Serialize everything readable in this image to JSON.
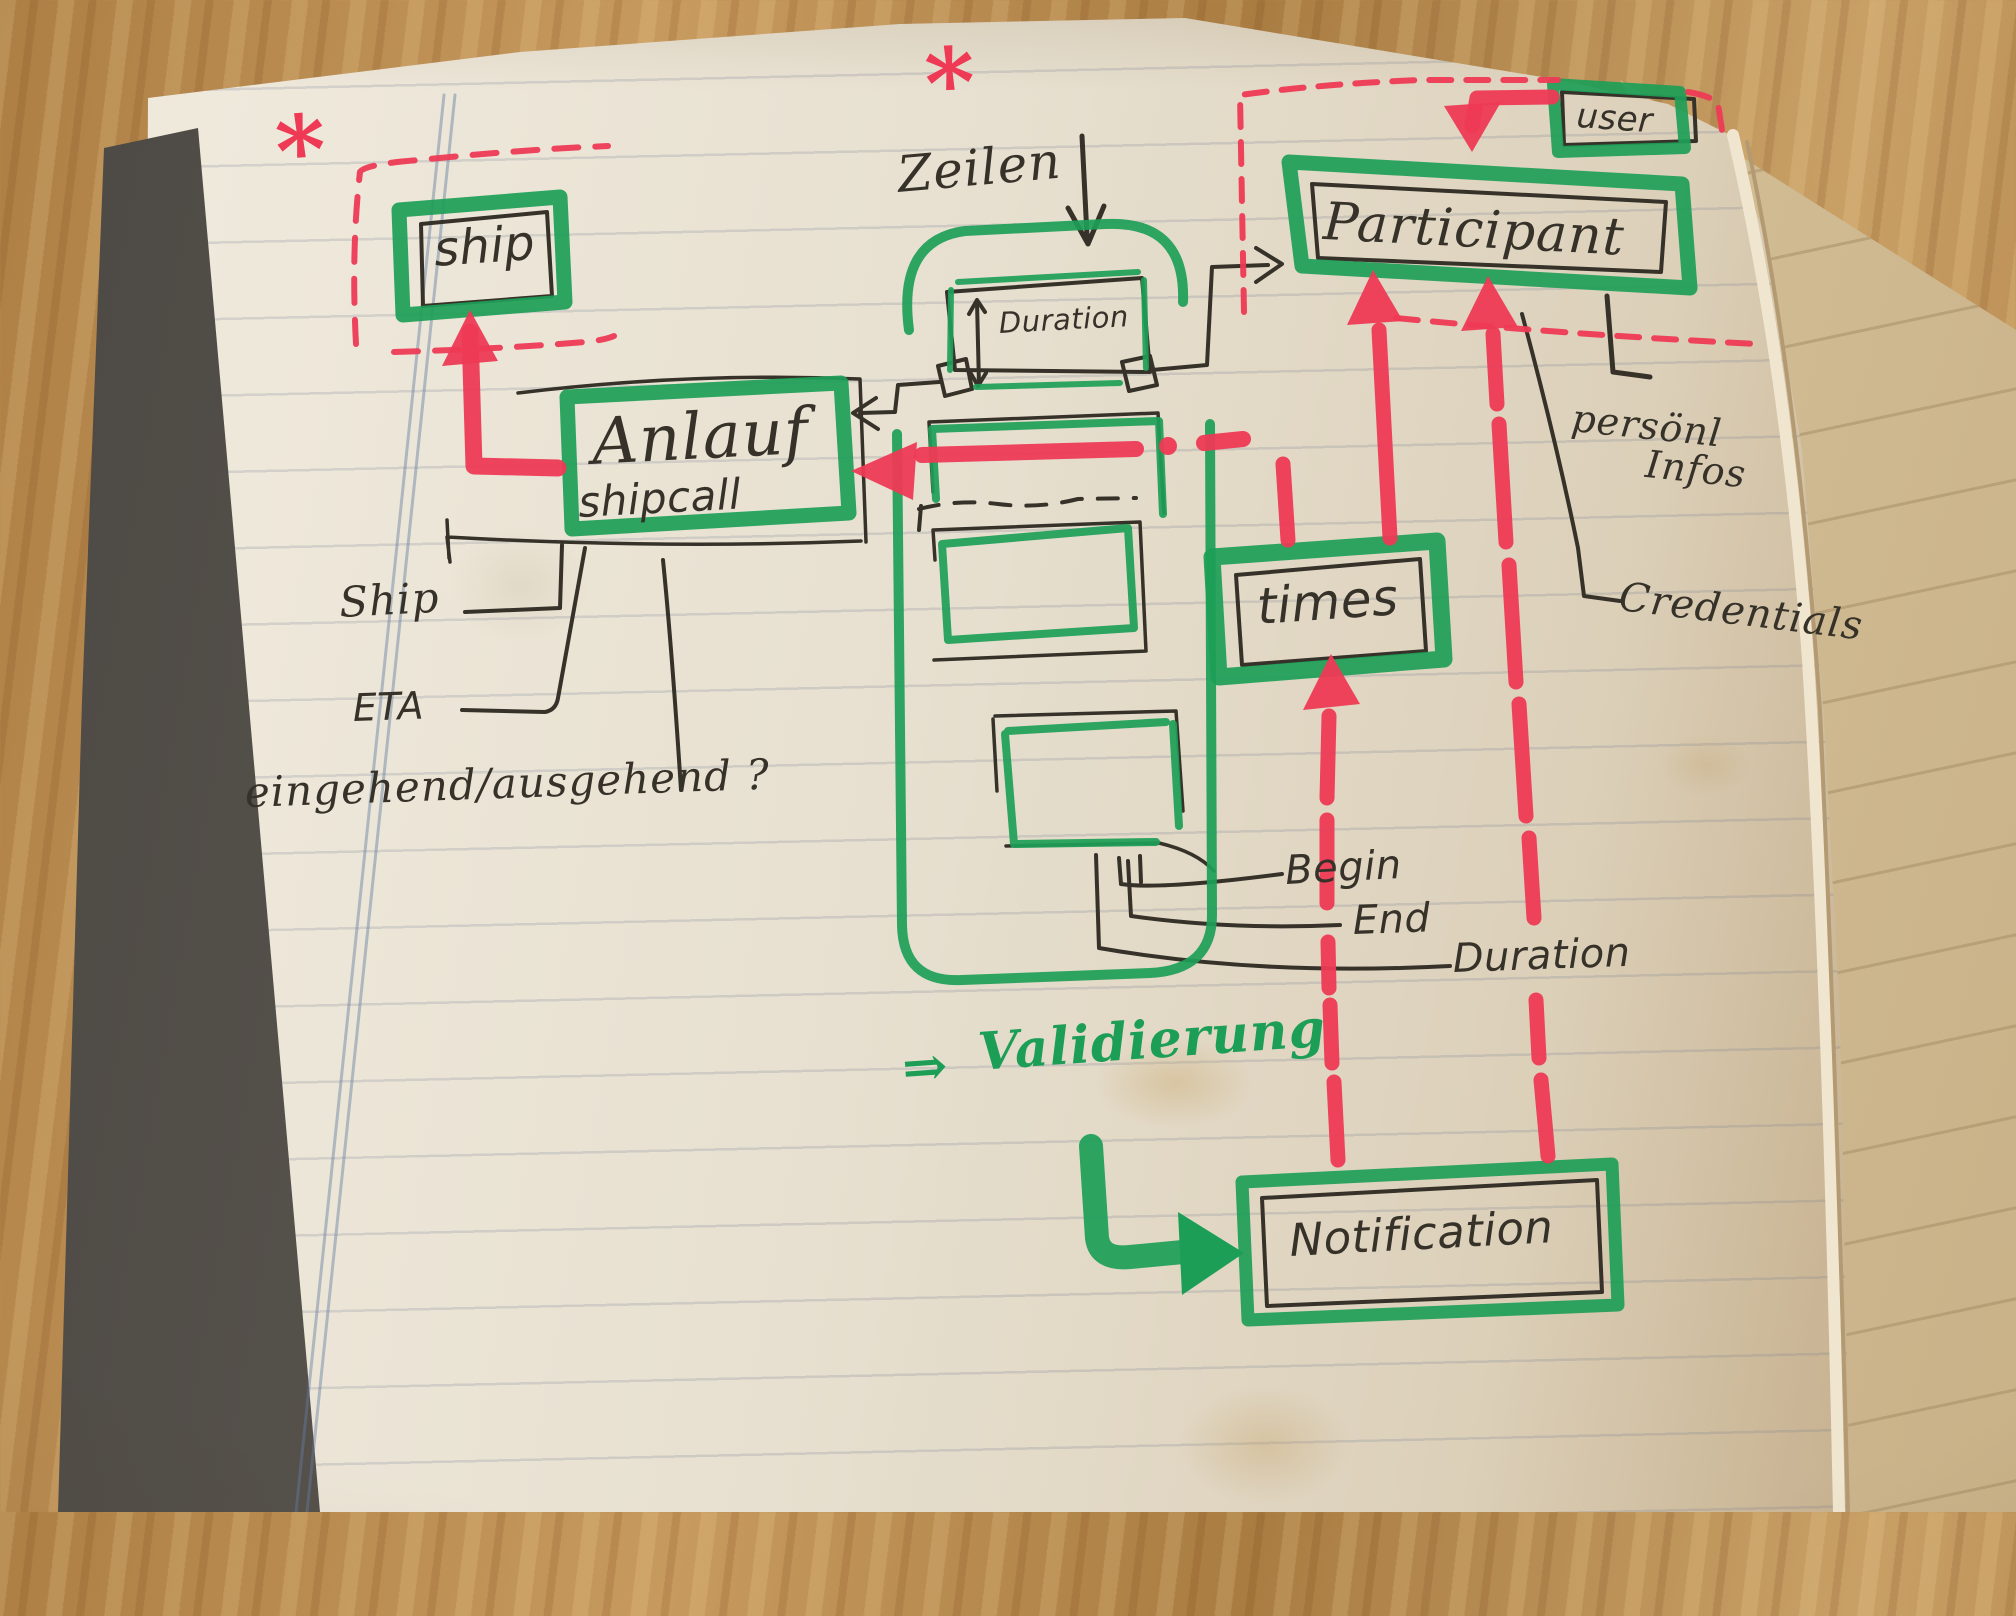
{
  "colors": {
    "marker_green": "#1d9e57",
    "marker_red": "#ee3a55",
    "ink": "#363229",
    "pencil": "#58534a",
    "page": "#e9e2d2",
    "wood": "#b5854b",
    "cover": "#55504a"
  },
  "nodes": {
    "ship": {
      "label": "ship"
    },
    "shipcall": {
      "label": "Anlauf",
      "sublabel": "shipcall"
    },
    "duration_box": {
      "label": "Duration"
    },
    "participant": {
      "label": "Participant"
    },
    "user": {
      "label": "user"
    },
    "times": {
      "label": "times"
    },
    "notification": {
      "label": "Notification"
    }
  },
  "annotations": {
    "zeilen": "Zeilen",
    "ship_attr": "Ship",
    "eta": "ETA",
    "in_out": "eingehend/ausgehend ?",
    "begin": "Begin",
    "end": "End",
    "duration_attr": "Duration",
    "persoenl_line1": "persönl",
    "persoenl_line2": "Infos",
    "credentials": "Credentials",
    "validierung_arrow": "⇒",
    "validierung": "Validierung",
    "asterisk": "*"
  },
  "relations": [
    {
      "from": "Anlauf/shipcall",
      "to": "ship",
      "style": "red-arrow"
    },
    {
      "from": "user",
      "to": "Participant",
      "style": "red-arrow"
    },
    {
      "from": "times",
      "to": "Participant",
      "style": "red-arrow"
    },
    {
      "from": "Notification",
      "to": "times",
      "style": "red-arrow"
    },
    {
      "from": "Notification",
      "to": "Participant",
      "style": "red-arrow"
    },
    {
      "from": "Duration",
      "to": "Participant",
      "style": "ink-arrow"
    },
    {
      "from": "Duration",
      "to": "Anlauf/shipcall",
      "style": "ink-arrow"
    },
    {
      "from": "times-row",
      "to": "Anlauf/shipcall",
      "style": "red-dashed-arrow"
    },
    {
      "from": "Validierung",
      "to": "Notification",
      "style": "green-arrow"
    }
  ]
}
